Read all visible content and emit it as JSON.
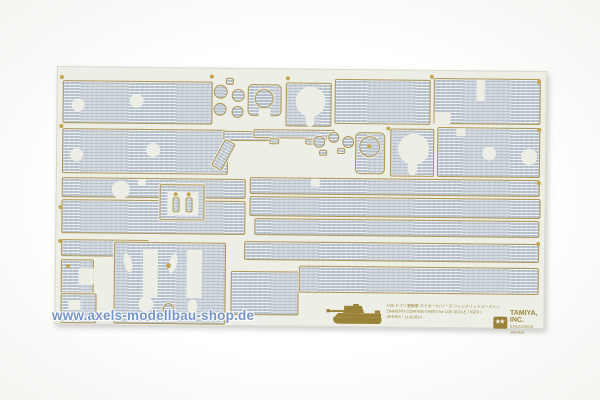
{
  "colors": {
    "background": "#ffffff",
    "sheet_base": "#edefe7",
    "zimmerit_texture": "#b4bfc9",
    "die_cut_outline": "#b29754",
    "print_gold": "#9a8338",
    "watermark_blue": "#6286be"
  },
  "watermark": {
    "text": "www.axels-modellbau-shop.de"
  },
  "sheet": {
    "spare_note": "●スペアシート・(35-IN 4 SIZE)"
  },
  "label": {
    "jp": "1/35 ドイツ重戦車 タイガーⅠシリーズ ツィンメリットコーティングシートセット",
    "en": "ZIMMERIT COATING SHEET for 1/35 SCALE TIGER I",
    "series": "SERIES・11421614"
  },
  "brand": {
    "stars": "★★",
    "name": "TAMIYA, INC.",
    "sub": "SHIZUOKA JAPAN"
  },
  "icons": {
    "tank": "tiger-i-tank-silhouette-icon",
    "logo": "tamiya-twin-star-logo-icon"
  }
}
